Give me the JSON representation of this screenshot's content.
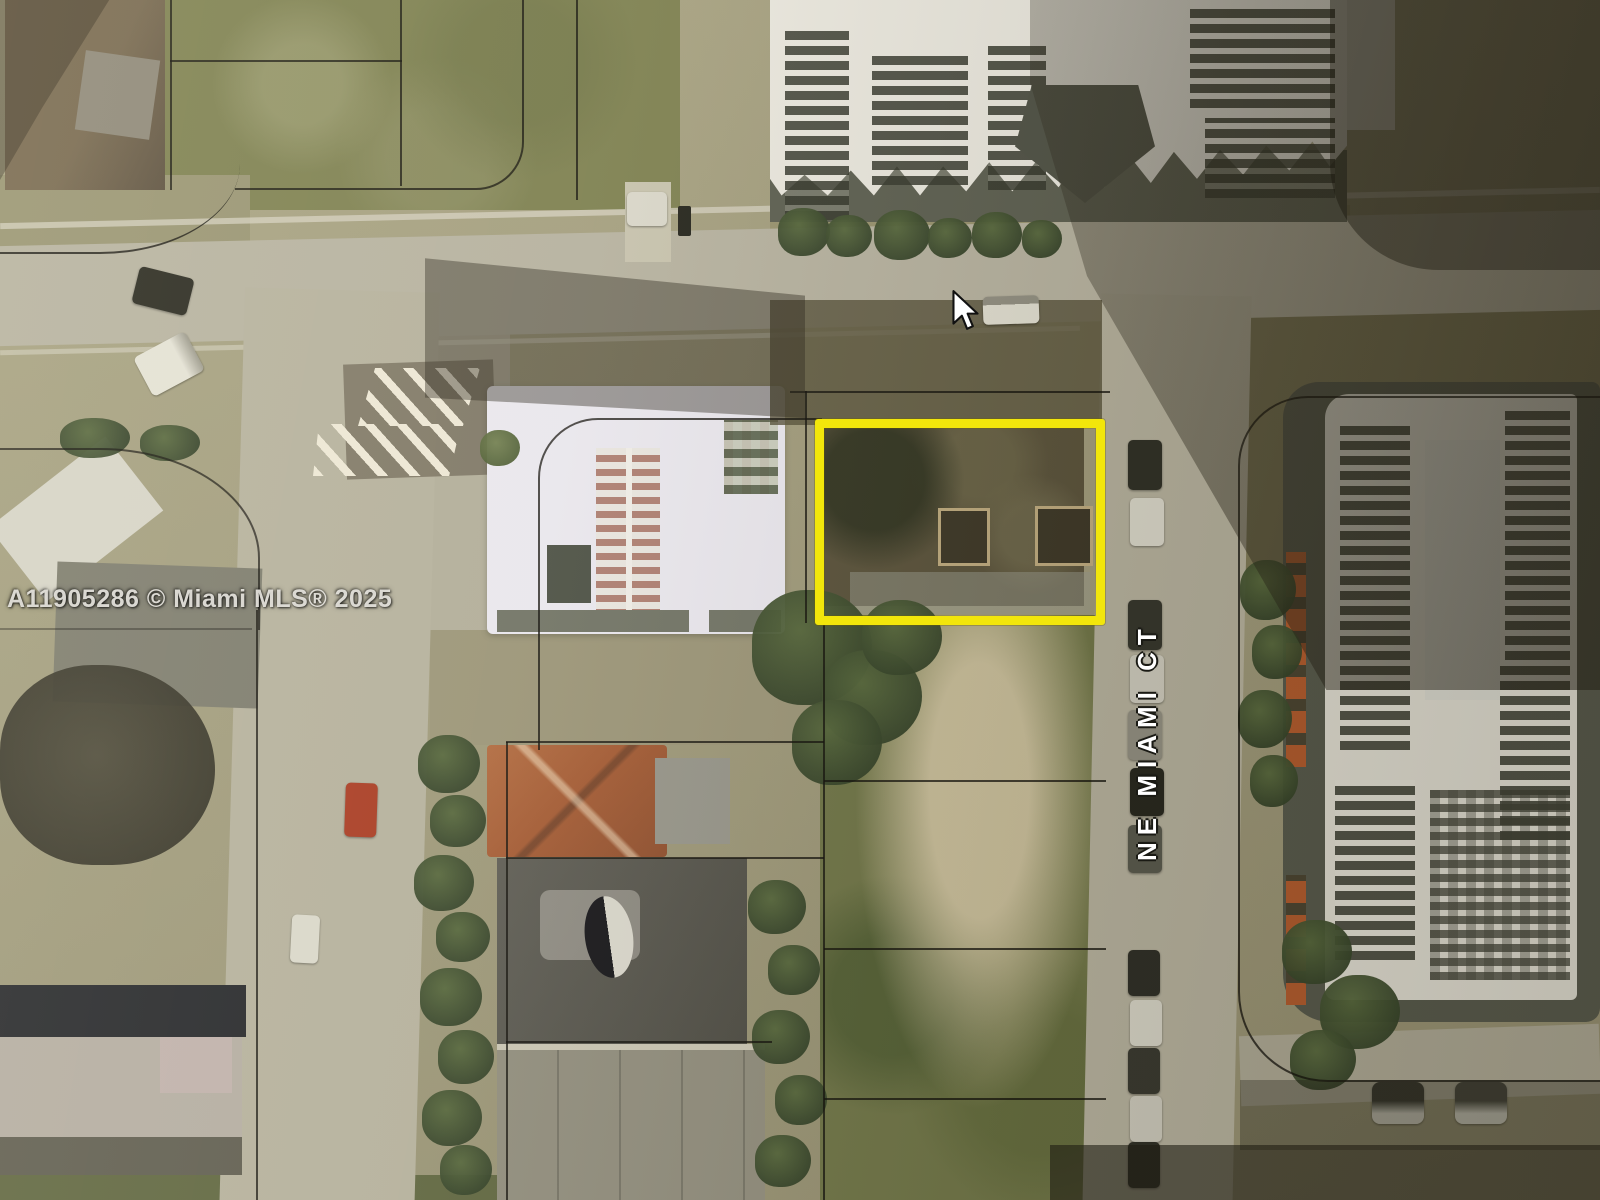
{
  "image": {
    "kind": "aerial-satellite-photo"
  },
  "watermark": {
    "text": "A11905286 © Miami MLS® 2025"
  },
  "street_label": {
    "text": "NE MIAMI CT"
  },
  "highlight": {
    "label": "subject-parcel-outline",
    "color": "#F2E60B"
  },
  "cursor": {
    "icon": "arrow-pointer"
  },
  "colors": {
    "highlight": "#F2E60B",
    "road": "#B5B1A0",
    "grass": "#75784A",
    "roof_white": "#E9E7EF",
    "roof_red": "#A5613B",
    "tree": "#3B4A2B",
    "label_text": "#FFFFFF",
    "watermark_text": "#E6E4DE"
  }
}
